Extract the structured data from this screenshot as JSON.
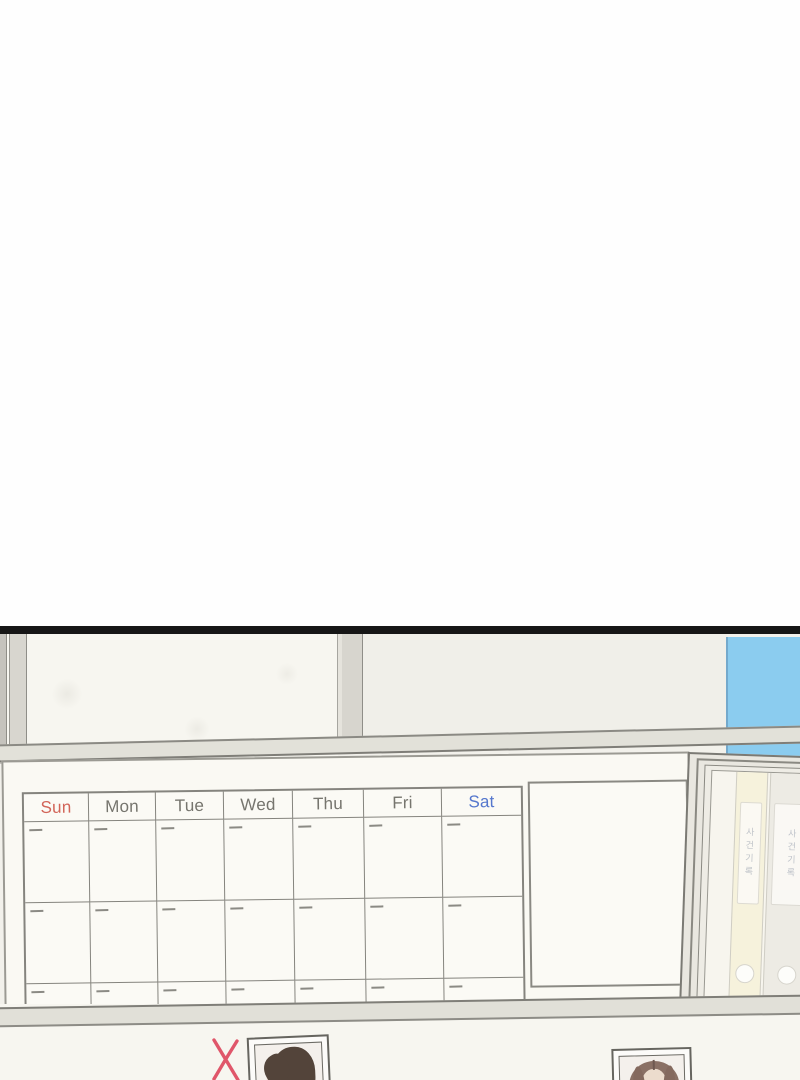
{
  "scene": {
    "calendar": {
      "day_headers": [
        {
          "label": "Sun",
          "color": "#d26559"
        },
        {
          "label": "Mon",
          "color": "#76756e"
        },
        {
          "label": "Tue",
          "color": "#76756e"
        },
        {
          "label": "Wed",
          "color": "#76756e"
        },
        {
          "label": "Thu",
          "color": "#76756e"
        },
        {
          "label": "Fri",
          "color": "#76756e"
        },
        {
          "label": "Sat",
          "color": "#5577cd"
        }
      ],
      "body_rows": 3,
      "columns": 7
    },
    "cabinet": {
      "binders": [
        {
          "label": "사건기록",
          "spine_color": "#f6f2dc",
          "left": 24,
          "width": 32
        },
        {
          "label": "사건기록",
          "spine_color": "#edebe4",
          "left": 58,
          "width": 48
        }
      ]
    },
    "board_photos": [
      {
        "name": "portrait-photo-left",
        "marked": true,
        "mark": "X"
      },
      {
        "name": "portrait-photo-right",
        "marked": false,
        "mark": ""
      }
    ],
    "colors": {
      "blue_wall": "#8bccef",
      "x_mark": "#e0566a",
      "sun_red": "#d26559",
      "sat_blue": "#5577cd",
      "weekday_gray": "#76756e",
      "panel_border": "#161616"
    }
  }
}
